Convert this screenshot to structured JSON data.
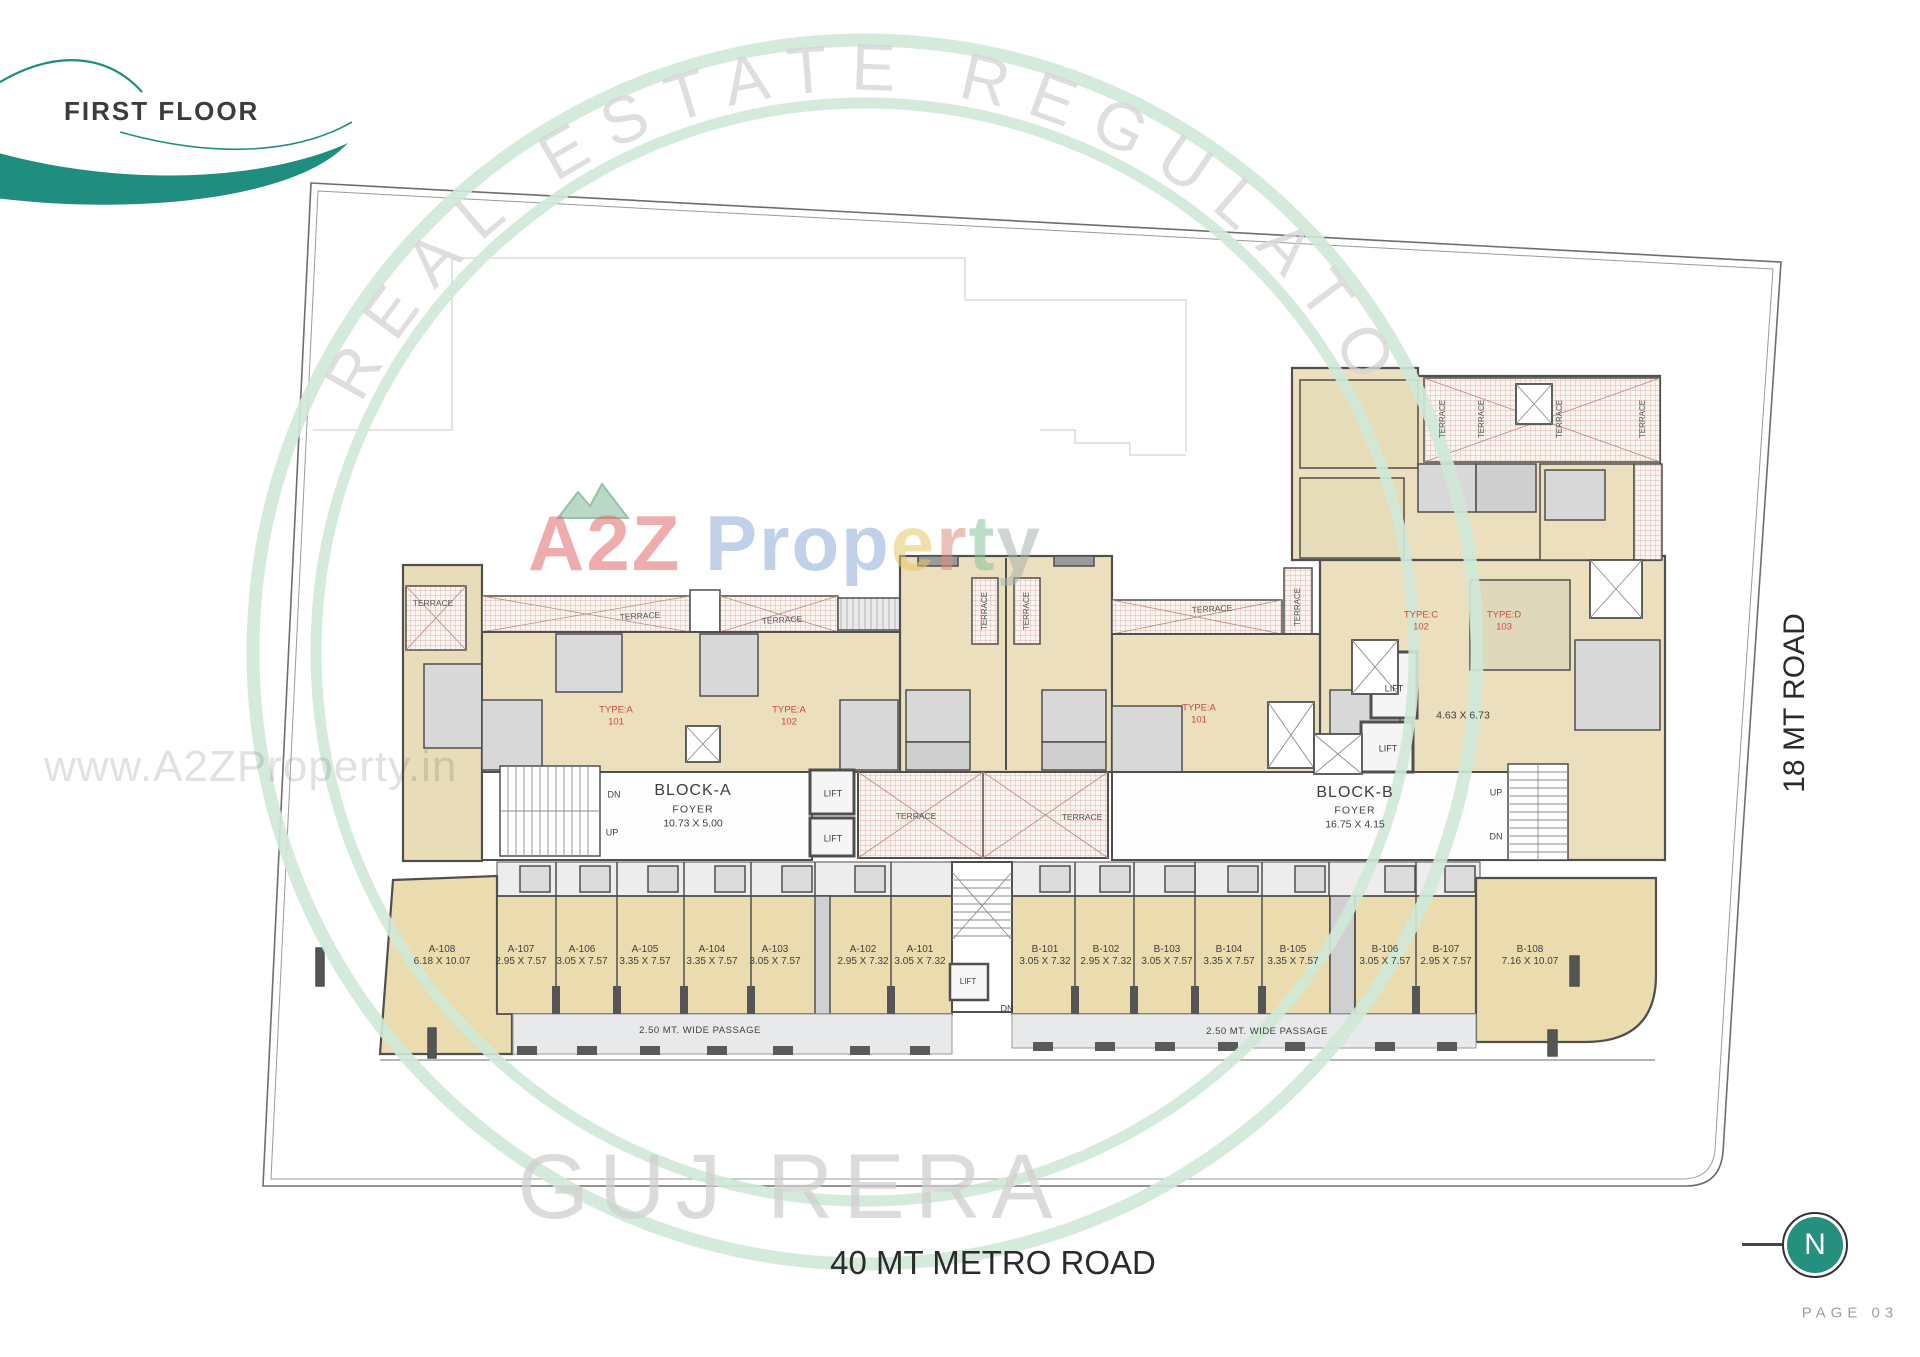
{
  "header": {
    "title": "FIRST FLOOR"
  },
  "roads": {
    "bottom": "40 MT METRO ROAD",
    "right": "18 MT ROAD"
  },
  "footer": {
    "page": "PAGE 03"
  },
  "north": {
    "letter": "N"
  },
  "watermarks": {
    "url": "www.A2ZProperty.in",
    "arc_top": "REAL ESTATE REGULATO",
    "arc_bottom": "GUJ RERA",
    "brand_parts": [
      {
        "t": "A",
        "c": "#e26a6a"
      },
      {
        "t": "2",
        "c": "#e26a6a"
      },
      {
        "t": "Z",
        "c": "#e26a6a"
      },
      {
        "t": " ",
        "c": "#ffffff"
      },
      {
        "t": "P",
        "c": "#8fadd8"
      },
      {
        "t": "r",
        "c": "#8fadd8"
      },
      {
        "t": "o",
        "c": "#8fadd8"
      },
      {
        "t": "p",
        "c": "#8fadd8"
      },
      {
        "t": "e",
        "c": "#e5c868"
      },
      {
        "t": "r",
        "c": "#dd8f7f"
      },
      {
        "t": "t",
        "c": "#86c29c"
      },
      {
        "t": "y",
        "c": "#a9b5ac"
      }
    ]
  },
  "colors": {
    "accent_teal": "#1f8e7e",
    "north_teal": "#25907e",
    "type_label_red": "#c94a3a",
    "room_tan": "#ecdfbe",
    "shop_tan": "#eadcae",
    "terrace_hatch": "#d4a096",
    "watermark_green": "#cfe9d8",
    "wall_gray": "#4f4f4f"
  },
  "plan": {
    "blocks": [
      {
        "name": "BLOCK-A",
        "foyer": "FOYER",
        "size": "10.73 X 5.00"
      },
      {
        "name": "BLOCK-B",
        "foyer": "FOYER",
        "size": "16.75 X 4.15"
      }
    ],
    "units": [
      {
        "id": "A-108",
        "dim": "6.18 X 10.07",
        "x": 442
      },
      {
        "id": "A-107",
        "dim": "2.95 X 7.57",
        "x": 521
      },
      {
        "id": "A-106",
        "dim": "3.05 X 7.57",
        "x": 582
      },
      {
        "id": "A-105",
        "dim": "3.35 X 7.57",
        "x": 645
      },
      {
        "id": "A-104",
        "dim": "3.35 X 7.57",
        "x": 712
      },
      {
        "id": "A-103",
        "dim": "3.05 X 7.57",
        "x": 775
      },
      {
        "id": "A-102",
        "dim": "2.95 X 7.32",
        "x": 863
      },
      {
        "id": "A-101",
        "dim": "3.05 X 7.32",
        "x": 920
      },
      {
        "id": "B-101",
        "dim": "3.05 X 7.32",
        "x": 1045
      },
      {
        "id": "B-102",
        "dim": "2.95 X 7.32",
        "x": 1106
      },
      {
        "id": "B-103",
        "dim": "3.05 X 7.57",
        "x": 1167
      },
      {
        "id": "B-104",
        "dim": "3.35 X 7.57",
        "x": 1229
      },
      {
        "id": "B-105",
        "dim": "3.35 X 7.57",
        "x": 1293
      },
      {
        "id": "B-106",
        "dim": "3.05 X 7.57",
        "x": 1385
      },
      {
        "id": "B-107",
        "dim": "2.95 X 7.57",
        "x": 1446
      },
      {
        "id": "B-108",
        "dim": "7.16 X 10.07",
        "x": 1530
      }
    ],
    "labels": [
      {
        "n": "block-a-name",
        "t": "BLOCK-A",
        "x": 693,
        "y": 791,
        "s": 16,
        "ls": 1
      },
      {
        "n": "block-a-foyer",
        "t": "FOYER",
        "x": 693,
        "y": 810,
        "s": 10.5,
        "ls": 1
      },
      {
        "n": "block-a-size",
        "t": "10.73 X 5.00",
        "x": 693,
        "y": 824,
        "s": 10.5
      },
      {
        "n": "block-b-name",
        "t": "BLOCK-B",
        "x": 1355,
        "y": 793,
        "s": 16,
        "ls": 1
      },
      {
        "n": "block-b-foyer",
        "t": "FOYER",
        "x": 1355,
        "y": 811,
        "s": 10.5,
        "ls": 1
      },
      {
        "n": "block-b-size",
        "t": "16.75 X 4.15",
        "x": 1355,
        "y": 825,
        "s": 10.5
      },
      {
        "n": "dim-463x673",
        "t": "4.63 X 6.73",
        "x": 1463,
        "y": 716,
        "s": 10.5
      },
      {
        "n": "lift-a-1",
        "t": "LIFT",
        "x": 833,
        "y": 794,
        "s": 9
      },
      {
        "n": "lift-a-2",
        "t": "LIFT",
        "x": 833,
        "y": 839,
        "s": 9
      },
      {
        "n": "lift-b-1",
        "t": "LIFT",
        "x": 1394,
        "y": 689,
        "s": 9
      },
      {
        "n": "lift-b-2",
        "t": "LIFT",
        "x": 1388,
        "y": 749,
        "s": 9
      },
      {
        "n": "lift-shops",
        "t": "LIFT",
        "x": 968,
        "y": 982,
        "s": 8
      },
      {
        "n": "stair-a-dn",
        "t": "DN",
        "x": 614,
        "y": 795,
        "s": 9
      },
      {
        "n": "stair-a-up",
        "t": "UP",
        "x": 612,
        "y": 833,
        "s": 9
      },
      {
        "n": "stair-b-up",
        "t": "UP",
        "x": 1496,
        "y": 793,
        "s": 9
      },
      {
        "n": "stair-b-dn",
        "t": "DN",
        "x": 1496,
        "y": 837,
        "s": 9
      },
      {
        "n": "stair-shops-dn",
        "t": "DN",
        "x": 1007,
        "y": 1009,
        "s": 9
      },
      {
        "n": "type-a-101-first",
        "t": "TYPE:A\n101",
        "x": 616,
        "y": 716,
        "s": 9.5,
        "c": "#c94a3a"
      },
      {
        "n": "type-a-102",
        "t": "TYPE:A\n102",
        "x": 789,
        "y": 716,
        "s": 9.5,
        "c": "#c94a3a"
      },
      {
        "n": "type-a-101-second",
        "t": "TYPE:A\n101",
        "x": 1199,
        "y": 714,
        "s": 9.5,
        "c": "#c94a3a"
      },
      {
        "n": "type-c-102",
        "t": "TYPE:C\n102",
        "x": 1421,
        "y": 621,
        "s": 9.5,
        "c": "#c94a3a"
      },
      {
        "n": "type-d-103",
        "t": "TYPE:D\n103",
        "x": 1504,
        "y": 621,
        "s": 9.5,
        "c": "#c94a3a"
      },
      {
        "n": "terrace-left-cap",
        "t": "TERRACE",
        "x": 433,
        "y": 603,
        "s": 8.5,
        "c": "#555555"
      },
      {
        "n": "terrace-a-1",
        "t": "TERRACE",
        "x": 640,
        "y": 616,
        "s": 8.5,
        "c": "#555555",
        "r": -3
      },
      {
        "n": "terrace-a-2",
        "t": "TERRACE",
        "x": 782,
        "y": 620,
        "s": 8.5,
        "c": "#555555",
        "r": -3
      },
      {
        "n": "terrace-mid-left",
        "t": "TERRACE",
        "x": 916,
        "y": 816,
        "s": 8.5,
        "c": "#555555"
      },
      {
        "n": "terrace-mid-right",
        "t": "TERRACE",
        "x": 1082,
        "y": 817,
        "s": 8.5,
        "c": "#555555"
      },
      {
        "n": "terrace-b",
        "t": "TERRACE",
        "x": 1212,
        "y": 609,
        "s": 8.5,
        "c": "#555555",
        "r": -3
      },
      {
        "n": "terrace-tower-left",
        "t": "TERRACE",
        "x": 985,
        "y": 611,
        "s": 8,
        "c": "#555555",
        "r": -90
      },
      {
        "n": "terrace-tower-right",
        "t": "TERRACE",
        "x": 1027,
        "y": 611,
        "s": 8,
        "c": "#555555",
        "r": -90
      },
      {
        "n": "terrace-vert-blockb",
        "t": "TERRACE",
        "x": 1298,
        "y": 607,
        "s": 8,
        "c": "#555555",
        "r": -90
      },
      {
        "n": "terrace-wing-1",
        "t": "TERRACE",
        "x": 1443,
        "y": 419,
        "s": 8,
        "c": "#555555",
        "r": -90
      },
      {
        "n": "terrace-wing-2",
        "t": "TERRACE",
        "x": 1482,
        "y": 419,
        "s": 8,
        "c": "#555555",
        "r": -90
      },
      {
        "n": "terrace-wing-3",
        "t": "TERRACE",
        "x": 1560,
        "y": 419,
        "s": 8,
        "c": "#555555",
        "r": -90
      },
      {
        "n": "terrace-wing-4",
        "t": "TERRACE",
        "x": 1643,
        "y": 419,
        "s": 8,
        "c": "#555555",
        "r": -90
      },
      {
        "n": "passage-a",
        "t": "2.50 MT. WIDE PASSAGE",
        "x": 700,
        "y": 1031,
        "s": 9.5,
        "ls": 0.5
      },
      {
        "n": "passage-b",
        "t": "2.50 MT. WIDE PASSAGE",
        "x": 1267,
        "y": 1032,
        "s": 9.5,
        "ls": 0.5
      }
    ]
  }
}
